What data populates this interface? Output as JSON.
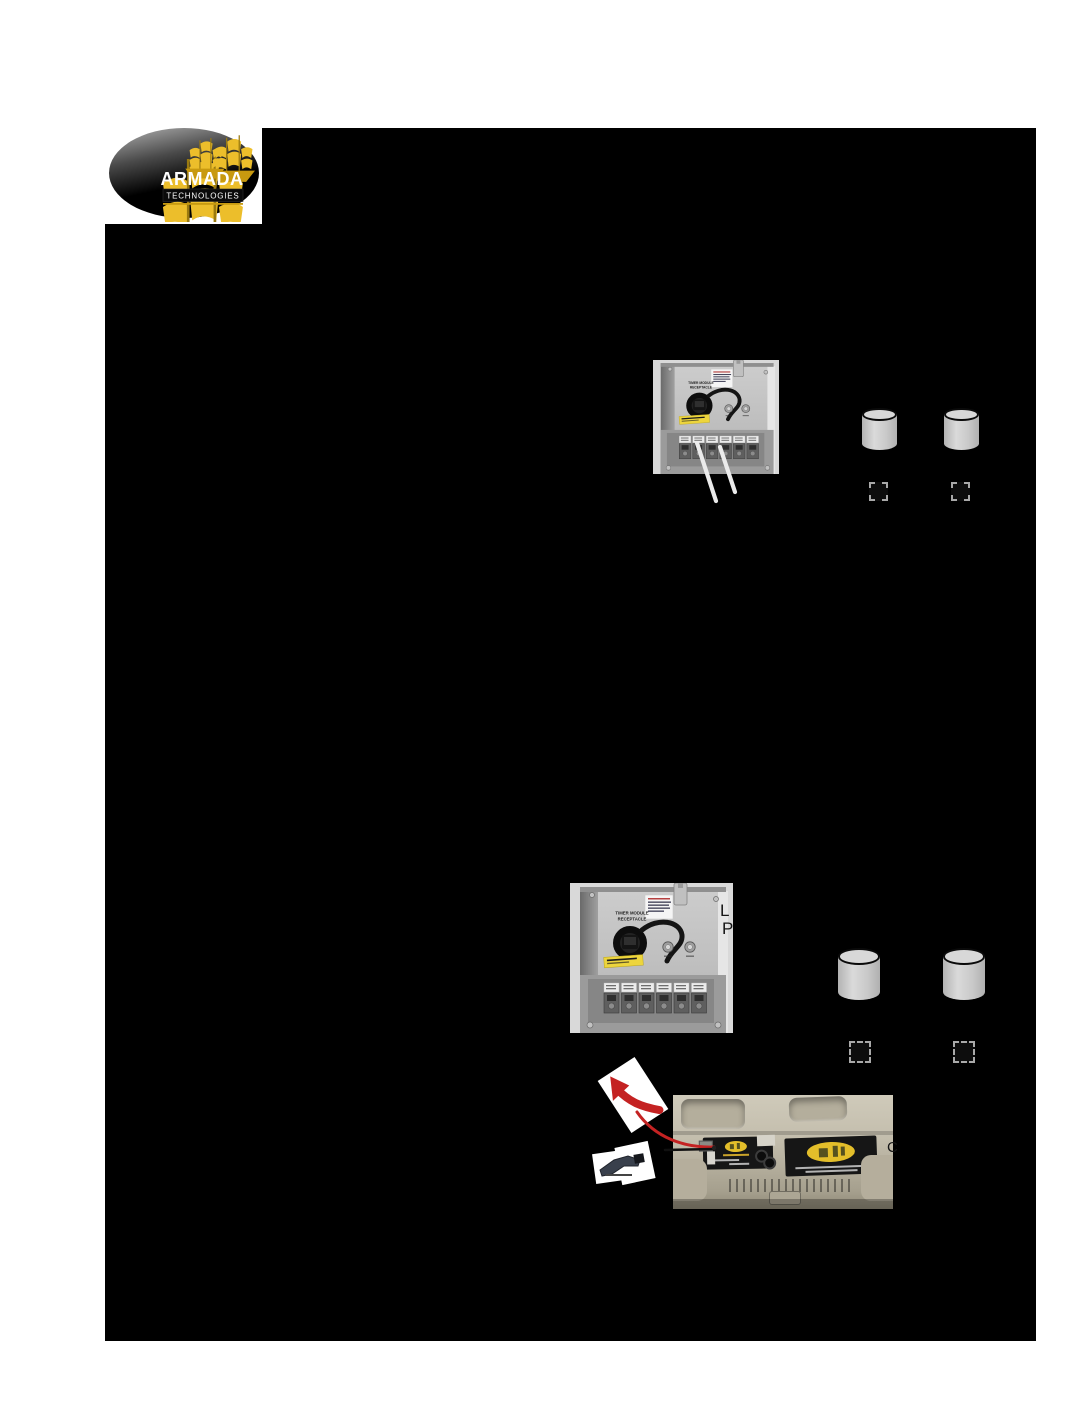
{
  "logo": {
    "brand": "ARMADA",
    "subtitle": "TECHNOLOGIES"
  },
  "transformer_photo": {
    "receptacle_label_line1": "TIMER MODULE",
    "receptacle_label_line2": "RECEPTACLE"
  },
  "text_fragments": {
    "beside_photo_line1": "L",
    "beside_photo_line2": "P",
    "beside_case": "C"
  },
  "checkboxes": {
    "group1": [
      "unchecked",
      "unchecked"
    ],
    "group2": [
      "unchecked",
      "unchecked"
    ]
  },
  "colors": {
    "page_background": "#ffffff",
    "redacted_block": "#000000",
    "cylinder_gray": "#c9c9c9",
    "brand_gold": "#e7b92a",
    "case_tan": "#c1bbaa",
    "arrow_red": "#c42222"
  },
  "icons": {
    "armada-logo": "black oval emblem with gold sailing ships",
    "battery-cylinder": "plain gray cylinder",
    "checkbox": "dashed outline square",
    "red-arrow": "curved red arrow cut-out",
    "battery-clip-icon": "dark clip connector cut-out",
    "transformer-photo": "transformer panel with timer module receptacle",
    "case-photo": "open carrying case with locator device"
  }
}
